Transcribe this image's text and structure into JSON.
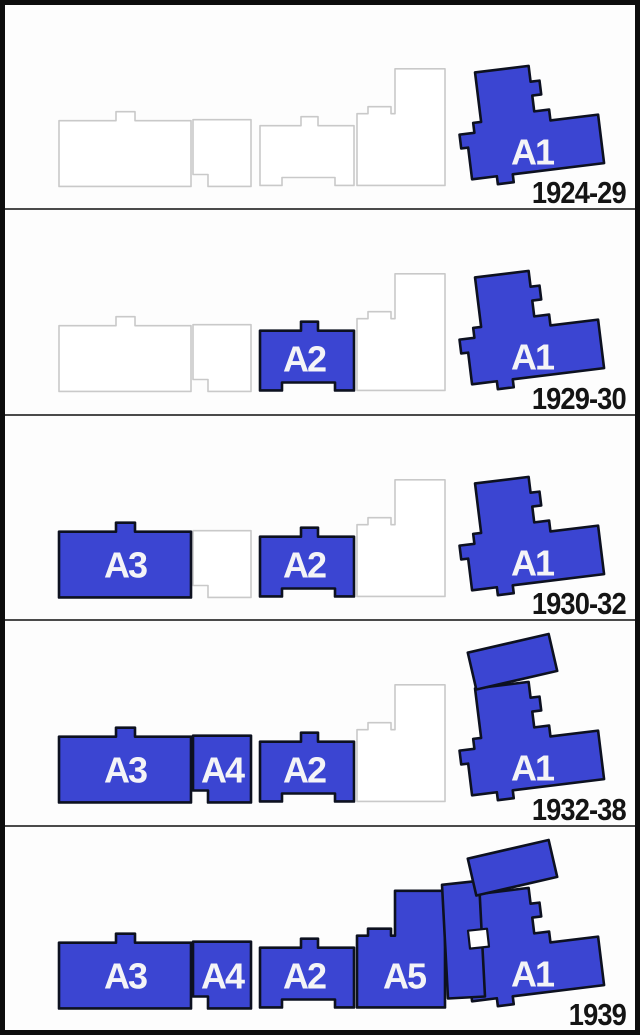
{
  "diagram": {
    "description": "Site plan diagram showing construction phases of buildings A1-A5 across five time periods",
    "building_order": [
      "A3",
      "A4",
      "A2",
      "A5",
      "A1"
    ],
    "buildings": {
      "A3": {
        "label": "A3",
        "points": "54,116 111,116 111,107 130,107 130,116 186,116 186,182 54,182",
        "label_x": 120,
        "label_y": 162
      },
      "A4": {
        "label": "A4",
        "points": "188,115 246,115 246,182 203,182 203,170 188,170",
        "label_x": 217,
        "label_y": 162
      },
      "A2": {
        "label": "A2",
        "points": "255,121 296,121 296,112 313,112 313,121 349,121 349,181 330,181 330,173 277,173 277,181 255,181",
        "label_x": 299,
        "label_y": 162
      },
      "A5": {
        "label": "A5",
        "points": "352,181 352,109 363,109 363,102 386,102 386,109 390,109 390,64 440,64 440,181",
        "label_x": 399,
        "label_y": 162
      },
      "A1": {
        "label": "A1",
        "points": "478,62 532,62 532,78 541,78 541,92 532,92 532,108 547,108 547,119 595,119 595,168 503,168 503,176 487,176 487,168 462,168 462,136 455,136 455,122 470,122 470,112 478,112",
        "rotate": "rotate(-7 520 130)",
        "label_x": 527,
        "label_y": 160
      }
    },
    "extras": {
      "a1_extension": {
        "points": "466,22 549,22 549,60 466,60",
        "rotate": "rotate(-13 507 41)"
      },
      "a5_annex": {
        "points": "437,58 474,54 480,170 443,172"
      },
      "junction_notch": {
        "points": "463,104 482,102 484,120 465,122"
      }
    },
    "panels": [
      {
        "year": "1924-29",
        "built": [
          "A1"
        ],
        "a1_extension": false,
        "a5_annex": false
      },
      {
        "year": "1929-30",
        "built": [
          "A2",
          "A1"
        ],
        "a1_extension": false,
        "a5_annex": false
      },
      {
        "year": "1930-32",
        "built": [
          "A3",
          "A2",
          "A1"
        ],
        "a1_extension": false,
        "a5_annex": false
      },
      {
        "year": "1932-38",
        "built": [
          "A3",
          "A4",
          "A2",
          "A1"
        ],
        "a1_extension": true,
        "a5_annex": false
      },
      {
        "year": "1939",
        "built": [
          "A3",
          "A4",
          "A2",
          "A5",
          "A1"
        ],
        "a1_extension": true,
        "a5_annex": true
      }
    ],
    "colors": {
      "built_fill": "#3b45d2",
      "built_stroke": "#0d1120",
      "unbuilt_stroke": "#c9c9c9",
      "label_color": "#f4f4f7",
      "year_color": "#141414",
      "divider": "#4a4a4a",
      "border": "#0d0d0d",
      "background": "#fdfdfd"
    }
  }
}
